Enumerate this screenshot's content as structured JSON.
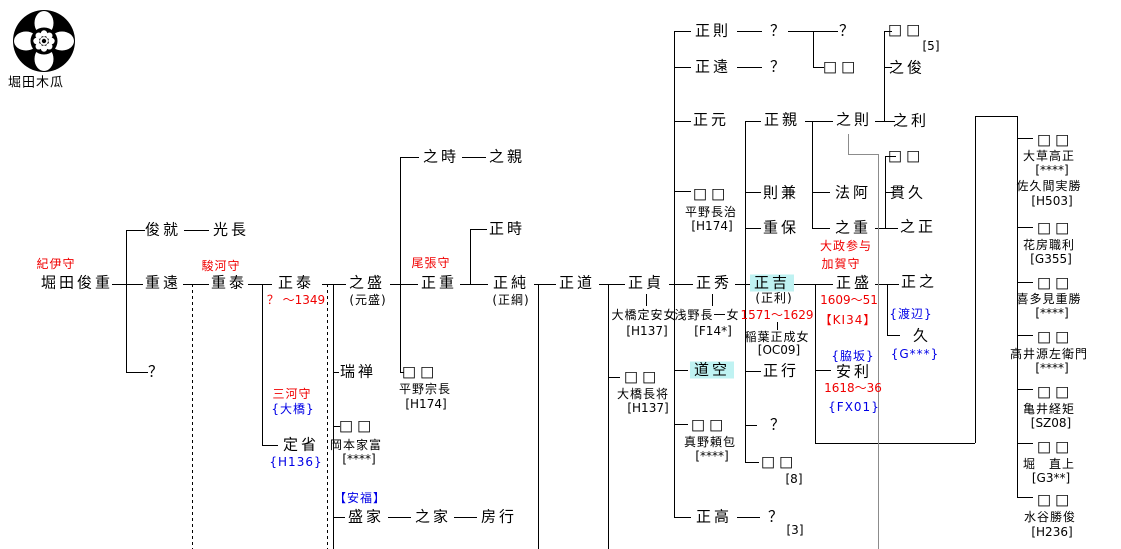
{
  "crest": {
    "label": "堀田木瓜"
  },
  "people": {
    "toshishige_title": "紀伊守",
    "toshishige": "堀田俊重",
    "toshinari": "俊就",
    "mitsunaga": "光長",
    "shigetoo": "重遠",
    "shigeyasu_title": "駿河守",
    "shigeyasu": "重泰",
    "gen2_q": "？",
    "masayasu": "正泰",
    "masayasu_dates": "？ ～1349",
    "sadami_title": "三河守",
    "sadami_family": "{大橋}",
    "sadami": "定省",
    "sadami_ref": "{H136}",
    "yukimori": "之盛",
    "yukimori_alt": "(元盛)",
    "zuizen": "瑞禅",
    "okamoto_d": "□□",
    "okamoto": "岡本家富",
    "okamoto_ref": "[****]",
    "anpuku": "【安福】",
    "morie": "盛家",
    "yukiie": "之家",
    "fusayuki": "房行",
    "masashige_title": "尾張守",
    "masashige": "正重",
    "yukitoki": "之時",
    "yukichika": "之親",
    "masatoki": "正時",
    "hirano_mune_d": "□□",
    "hirano_mune": "平野宗長",
    "hirano_mune_ref": "[H174]",
    "masazumi": "正純",
    "masazumi_alt": "(正綱)",
    "masamichi": "正道",
    "masasada": "正貞",
    "masasada_wife": "大橋定安女",
    "masasada_wife_ref": "[H137]",
    "ohashi_d": "□□",
    "ohashi": "大橋長将",
    "ohashi_ref": "[H137]",
    "masanori": "正則",
    "masanori_child": "？",
    "masatoo": "正遠",
    "masatoo_child": "？",
    "grandchild_q": "？",
    "grandchild_d": "□□",
    "box5_d": "□□",
    "box5_ref": "[5]",
    "yukitoshi": "之俊",
    "masamoto": "正元",
    "hirano_naga_d": "□□",
    "hirano_naga": "平野長治",
    "hirano_naga_ref": "[H174]",
    "masachika": "正親",
    "norikane": "則兼",
    "shigeyasu_b": "重保",
    "yukinori": "之則",
    "hoa": "法阿",
    "yukishige": "之重",
    "yukishige_d": "□□",
    "tsurahisa": "貫久",
    "yukimasa": "之正",
    "yukitoshi_r": "之利",
    "masahide": "正秀",
    "masahide_wife": "浅野長一女",
    "masahide_wife_ref": "[F14*]",
    "doku": "道空",
    "mano_d": "□□",
    "mano": "真野頼包",
    "mano_ref": "[****]",
    "masataka": "正高",
    "masataka_child": "？",
    "masataka_child_ref": "[3]",
    "masayoshi": "正吉",
    "masayoshi_alt": "(正利)",
    "masayoshi_dates": "1571～1629",
    "masayoshi_wife": "稲葉正成女",
    "masayoshi_wife_ref": "[OC09]",
    "masayuki": "正行",
    "masahide_q": "？",
    "box8_d": "□□",
    "box8_ref": "[8]",
    "masamori_title1": "大政参与",
    "masamori_title2": "加賀守",
    "masamori": "正盛",
    "masamori_dates": "1609～51",
    "masamori_ref": "【KI34】",
    "wakisaka": "{脇坂}",
    "yasutoshi": "安利",
    "yasutoshi_dates": "1618～36",
    "yasutoshi_ref": "{FX01}",
    "masayuki_m": "正之",
    "watanabe": "{渡辺}",
    "hisa": "久",
    "hisa_ref": "{G***}",
    "d1_d": "□□",
    "d1_h1": "大草高正",
    "d1_h1_ref": "[****]",
    "d1_h2": "佐久間実勝",
    "d1_h2_ref": "[H503]",
    "d2_d": "□□",
    "d2_h": "花房職利",
    "d2_ref": "[G355]",
    "d3_d": "□□",
    "d3_h": "喜多見重勝",
    "d3_ref": "[****]",
    "d4_d": "□□",
    "d4_h": "高井源左衛門",
    "d4_ref": "[****]",
    "d5_d": "□□",
    "d5_h": "亀井経矩",
    "d5_ref": "[SZ08]",
    "d6_d": "□□",
    "d6_h": "堀　直上",
    "d6_ref": "[G3**]",
    "d7_d": "□□",
    "d7_h": "水谷勝俊",
    "d7_ref": "[H236]"
  }
}
